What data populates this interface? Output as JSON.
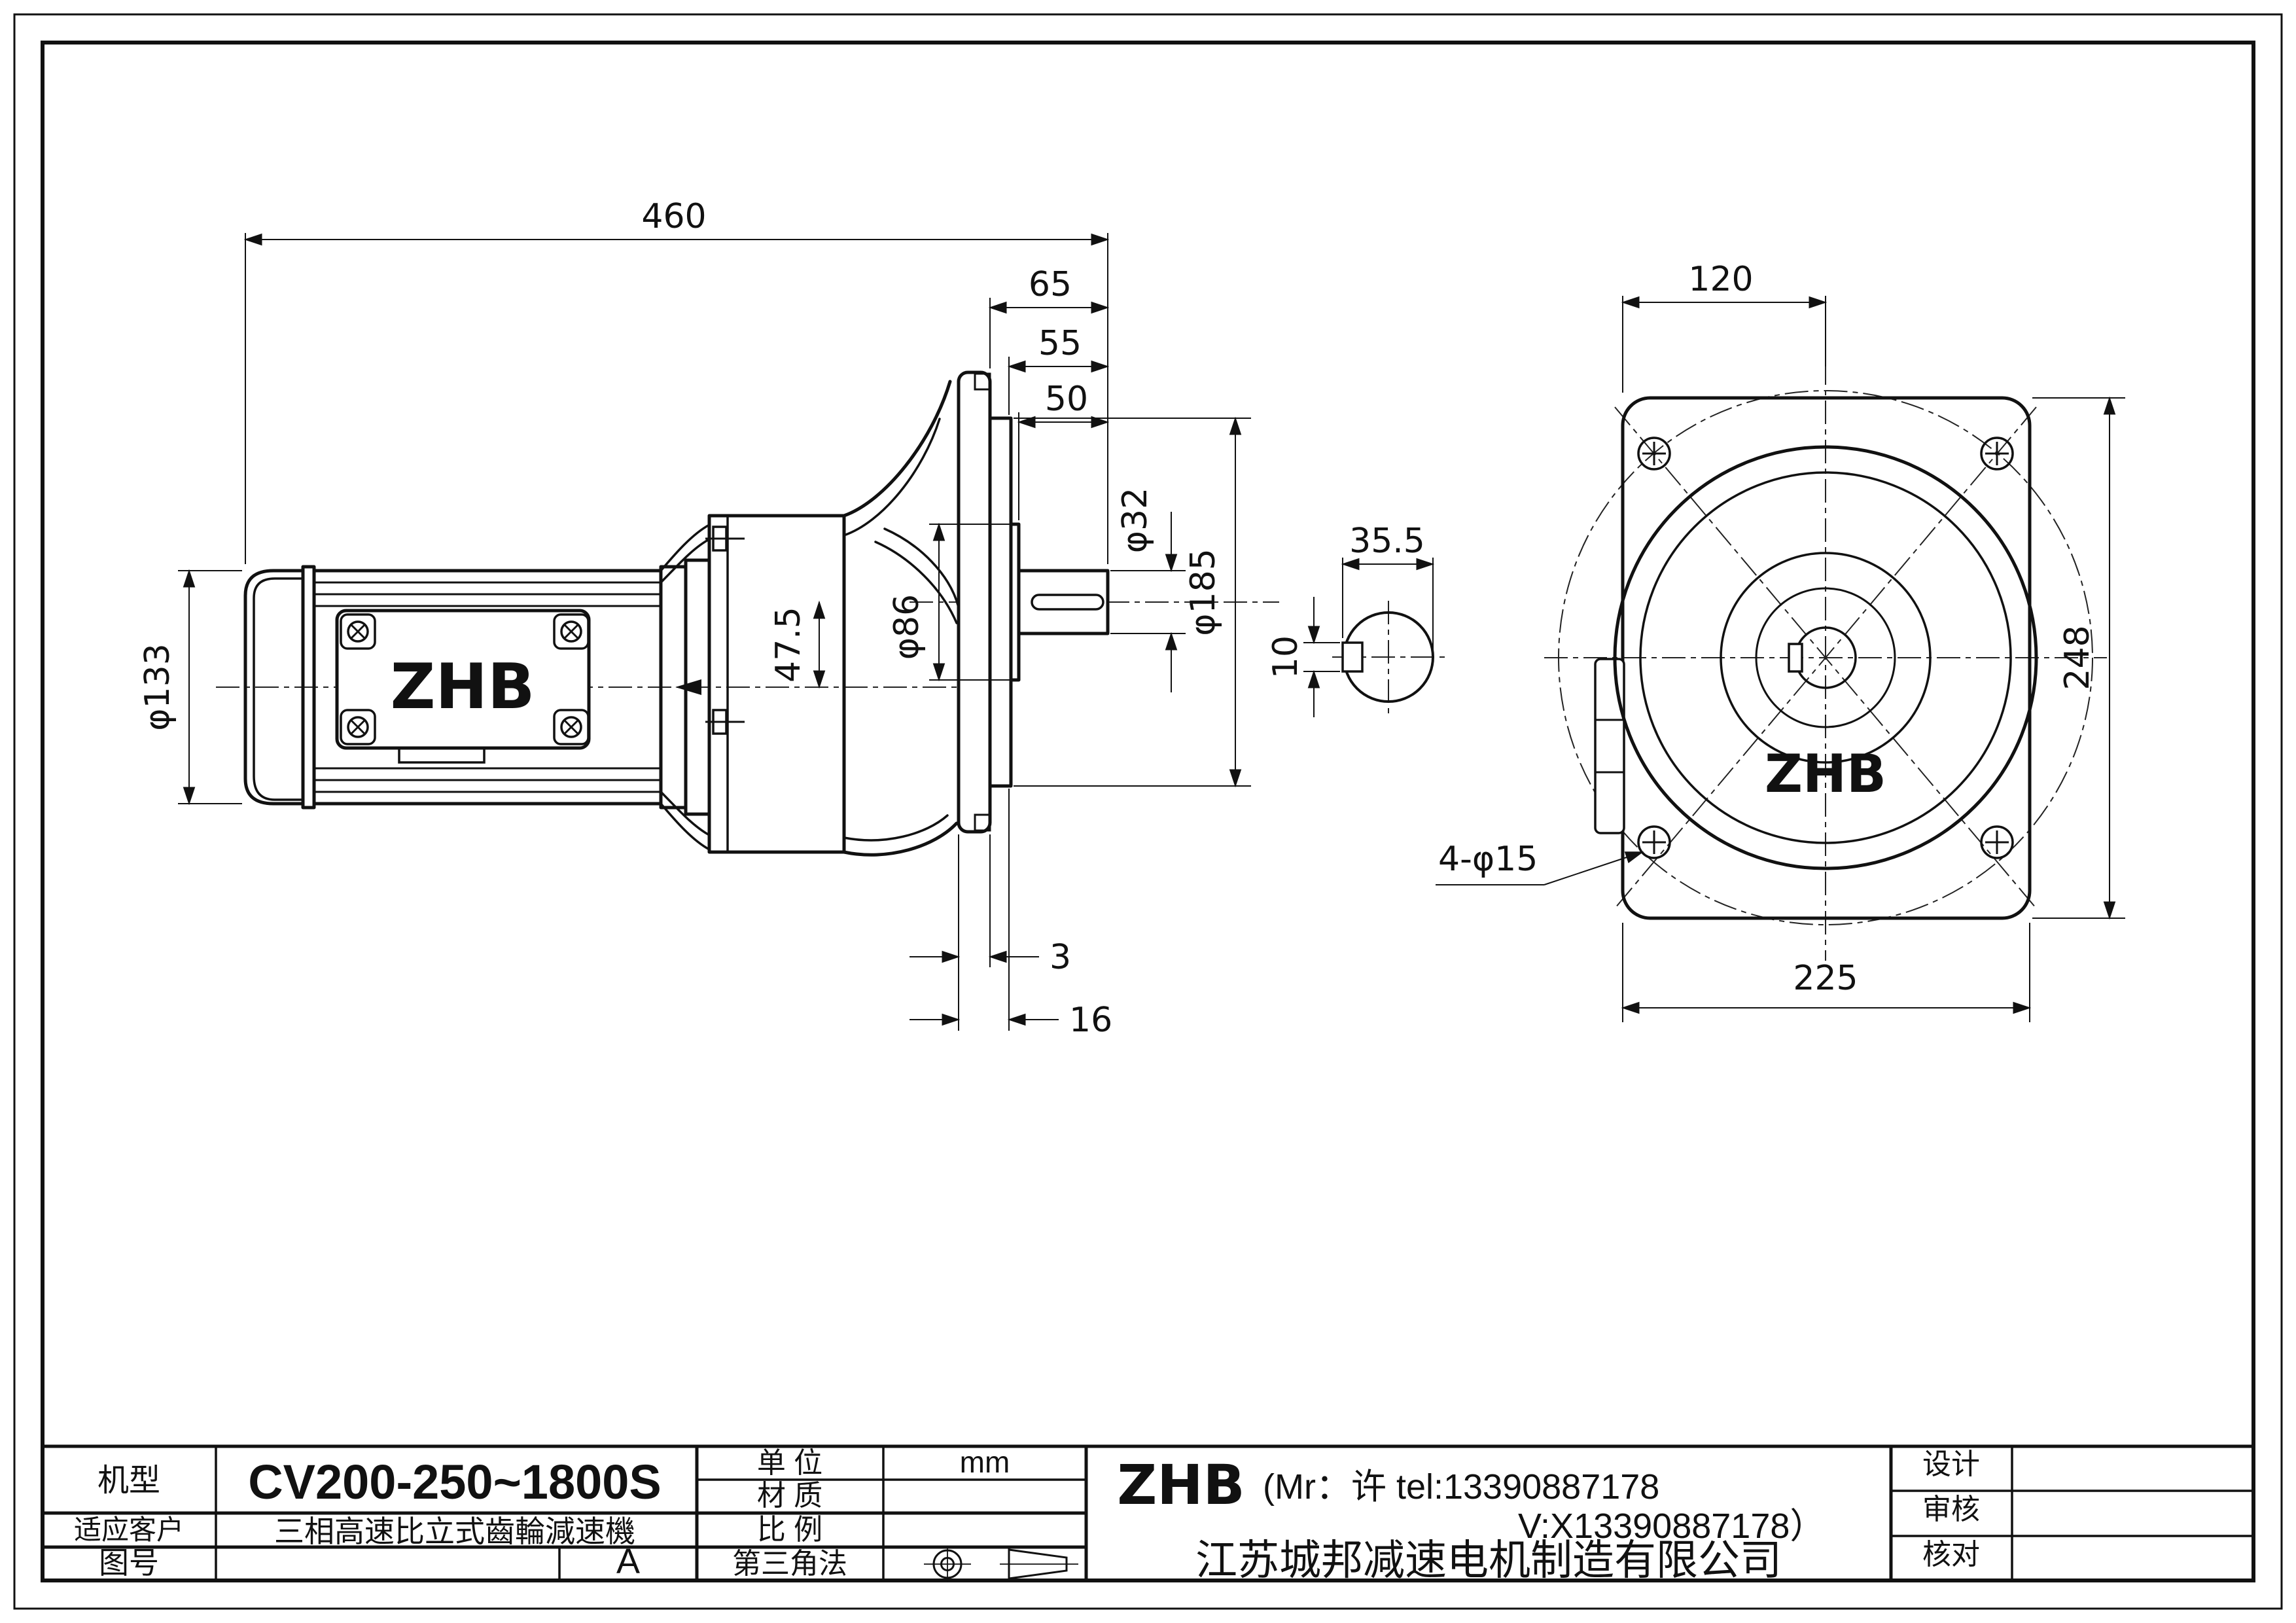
{
  "side_view": {
    "overall_length": "460",
    "ext_65": "65",
    "ext_55": "55",
    "ext_50": "50",
    "shaft_dia": "φ32",
    "spigot_dia": "φ185",
    "boss_dia": "φ86",
    "axis_offset": "47.5",
    "motor_dia": "φ133",
    "gap_3": "3",
    "depth_16": "16",
    "brand": "ZHB"
  },
  "front_view": {
    "bolt_offset": "120",
    "flange_height": "248",
    "flange_width": "225",
    "bolt_holes": "4-φ15",
    "brand": "ZHB"
  },
  "key_section": {
    "width_across": "35.5",
    "key_width": "10"
  },
  "title_block": {
    "model_label": "机型",
    "model_value": "CV200-250~1800S",
    "client_label": "适应客户",
    "client_value": "三相高速比立式齒輪減速機",
    "drawing_no_label": "图号",
    "rev_value": "A",
    "unit_label": "单 位",
    "unit_value": "mm",
    "material_label": "材 质",
    "material_value": "",
    "scale_label": "比 例",
    "scale_value": "",
    "projection_label": "第三角法",
    "brand": "ZHB",
    "contact_line1": "(Mr：许 tel:13390887178",
    "contact_line2": "V:X13390887178）",
    "company": "江苏城邦减速电机制造有限公司",
    "design_label": "设计",
    "review_label": "审核",
    "check_label": "核对"
  }
}
